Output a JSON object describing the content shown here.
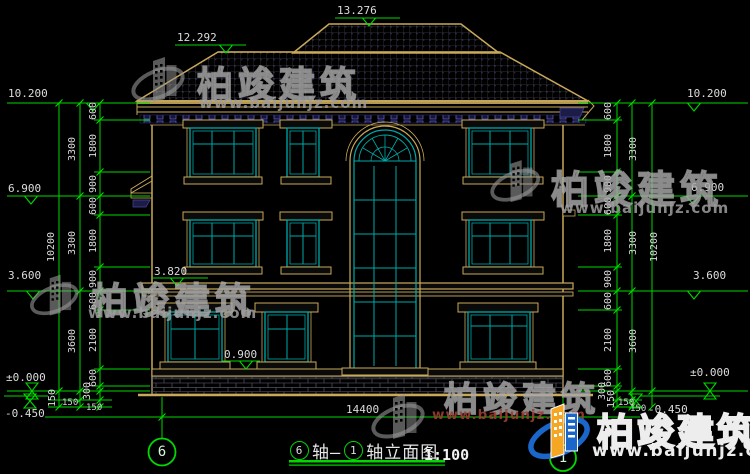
{
  "drawing": {
    "scale": "1:100",
    "bottom_total_dim": "14400"
  },
  "title": {
    "axis_start_num": "6",
    "axis_mid": "轴—",
    "axis_end_num": "1",
    "name_suffix": "轴立面图"
  },
  "axis_bubbles": {
    "left": "6",
    "right": "1"
  },
  "elevation_markers": {
    "top": [
      "13.276",
      "12.292"
    ],
    "left": [
      "10.200",
      "6.900",
      "3.600",
      "±0.000",
      "-0.450"
    ],
    "right": [
      "10.200",
      "6.900",
      "3.600",
      "±0.000",
      "-0.450"
    ],
    "inner": [
      "3.820",
      "0.900"
    ]
  },
  "dim_chains": {
    "left_detail": [
      "600",
      "1800",
      "900",
      "600",
      "1800",
      "900",
      "600",
      "2100",
      "600",
      "300"
    ],
    "left_floor": [
      "3300",
      "3300",
      "3600"
    ],
    "left_total": "10200",
    "left_base": [
      "150",
      "150",
      "150"
    ],
    "right_detail": [
      "600",
      "1800",
      "900",
      "600",
      "1800",
      "900",
      "600",
      "2100",
      "600",
      "300"
    ],
    "right_floor": [
      "3300",
      "3300",
      "3600"
    ],
    "right_total": "10200",
    "right_base": [
      "150",
      "150",
      "150"
    ]
  },
  "watermark": {
    "brand": "柏竣建筑",
    "url": "www.baijunjz.com"
  },
  "colors": {
    "dim_green": "#00d800",
    "text_white": "#dcdcdc",
    "outline_tan": "#C9A959",
    "window_teal": "#00A8A8",
    "dentil_blue": "#5050b0",
    "logo_blue": "#1B66C9",
    "logo_orange": "#F5A623"
  }
}
